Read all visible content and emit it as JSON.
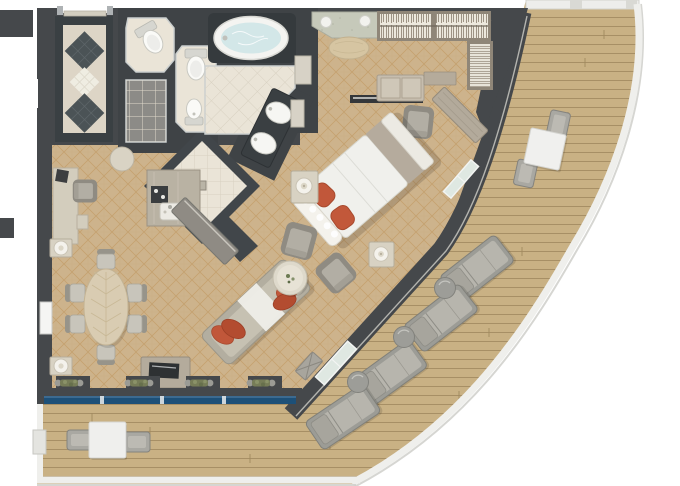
{
  "scene": {
    "type": "floor-plan",
    "description": "suite floor plan with curved wrap-around veranda"
  },
  "colors": {
    "background": "#ffffff",
    "wall": "#45484b",
    "wall_dark": "#3a4043",
    "carpet": "#cdb38c",
    "carpet_line": "#bb9156",
    "tile": "#eae4d7",
    "tile_line": "#d8d1c1",
    "marble": "#ddd5c6",
    "deck_wood": "#c9b184",
    "deck_line": "#a18a5f",
    "railing": "#efefec",
    "water": "#d3e7e8",
    "window_glass": "#1d5078",
    "door_glass": "#dfe8e2",
    "accent_pillow": "#c1573a",
    "furniture_gray": "#a9a59c",
    "furniture_white": "#f1f1ef",
    "wood_light": "#d9ccb2",
    "plant_green": "#7d8560"
  },
  "rooms": {
    "entry_foyer": [
      "double-entry-door",
      "marble-floor",
      "dark-diamond-inlay",
      "dark-diamond-inlay",
      "light-diamond-inlay"
    ],
    "bathroom": [
      "oval-bathtub",
      "twin-basin-vanity",
      "toilet-room",
      "toilet-and-bidet-room",
      "shower-room",
      "linen-room",
      "round-stool"
    ],
    "wet_bar": [
      "bar-counter-with-sink",
      "bar-island"
    ],
    "bedroom": [
      "king-bed",
      "red-accent-pillows",
      "nightstand-with-lamp",
      "nightstand-with-lamp",
      "armchair",
      "armchair",
      "wall-shelf",
      "dressing-console",
      "vanity-armchair",
      "glass-door-to-veranda"
    ],
    "walk_in_closet": [
      "hanging-wardrobe",
      "shelf-tower",
      "dressing-desk",
      "granite-basin-counter",
      "oval-pouf"
    ],
    "living_dining": [
      "oval-dining-table",
      "dining-chairs-x6",
      "sofa-with-red-pillows",
      "round-coffee-table",
      "tv-console",
      "writing-desk",
      "desk-chair",
      "marble-pedestal-lamp",
      "marble-pedestal-lamp",
      "window-planters-x4",
      "folding-bench",
      "glass-door-to-veranda"
    ],
    "veranda": [
      "square-table-with-2-chairs",
      "square-table-with-2-chairs",
      "sun-lounger",
      "sun-lounger",
      "sun-lounger",
      "sun-lounger",
      "round-side-table",
      "round-side-table",
      "round-side-table",
      "curved-railing",
      "teak-deck"
    ]
  }
}
